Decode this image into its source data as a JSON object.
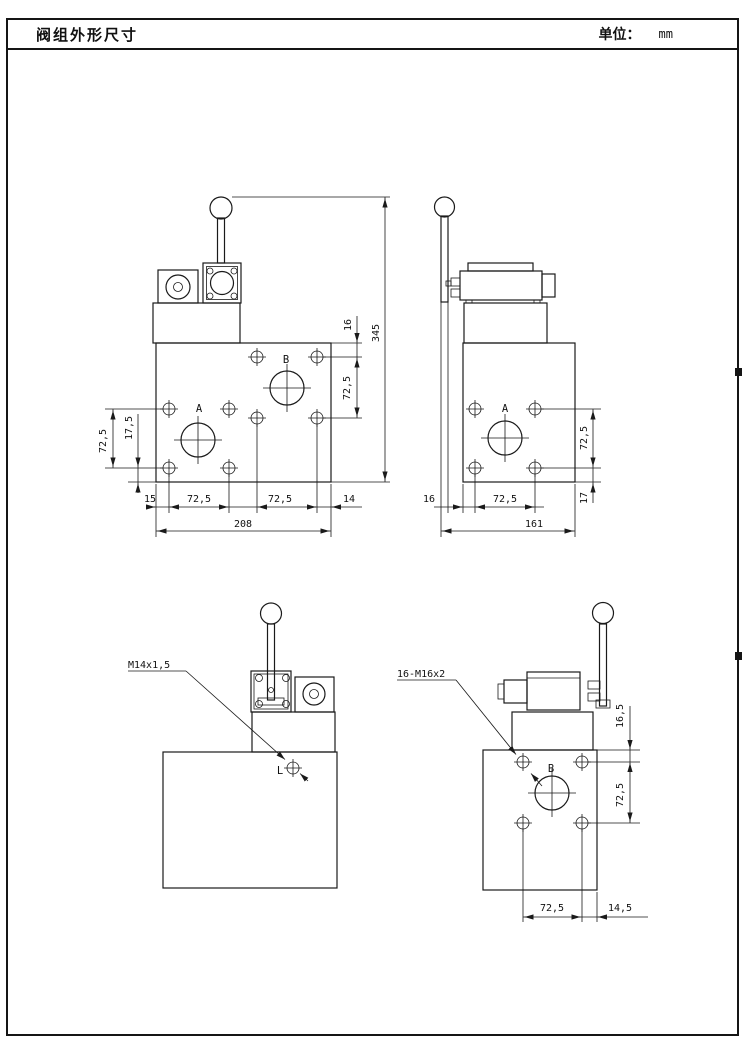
{
  "page": {
    "title": "阀组外形尺寸",
    "unit_label": "单位：",
    "unit_value": "mm"
  },
  "front_view": {
    "port_a": "A",
    "port_b": "B",
    "dim_top_hole_offset": "16",
    "dim_overall_height": "345",
    "dim_right_hole_spacing": "72,5",
    "dim_left_hole_spacing": "72,5",
    "dim_left_bottom_offset": "17,5",
    "dim_bottom_left_margin": "15",
    "dim_bottom_spacing_left": "72,5",
    "dim_bottom_spacing_right": "72,5",
    "dim_bottom_right_margin": "14",
    "dim_overall_width": "208"
  },
  "side_view": {
    "port_a": "A",
    "dim_right_hole_spacing": "72,5",
    "dim_right_bottom_offset": "17",
    "dim_bottom_left_margin": "16",
    "dim_bottom_hole_spacing": "72,5",
    "dim_overall_width": "161"
  },
  "back_view": {
    "thread_callout": "M14x1,5",
    "port_l": "L"
  },
  "side_back_view": {
    "thread_callout": "16-M16x2",
    "port_b": "B",
    "dim_right_top_offset": "16,5",
    "dim_right_hole_spacing": "72,5",
    "dim_bottom_hole_spacing": "72,5",
    "dim_bottom_right_margin": "14,5"
  }
}
